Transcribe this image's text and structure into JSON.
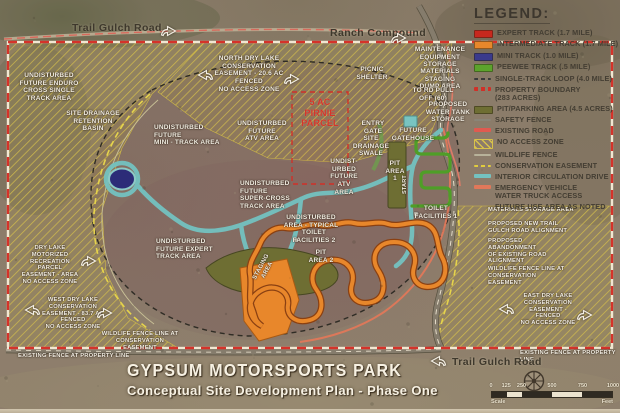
{
  "title": {
    "line1": "GYPSUM  MOTORSPORTS PARK",
    "line2": "Conceptual Site Development Plan - Phase One"
  },
  "legend": {
    "heading": "LEGEND:",
    "items": [
      {
        "label": "EXPERT TRACK (1.7 MILE)",
        "swatch": "solid",
        "color": "#c8281e"
      },
      {
        "label": "INTERMEDIATE TRACK (1.7 MILE)",
        "swatch": "solid",
        "color": "#e8872b"
      },
      {
        "label": "MINI TRACK (1.0 MILE)",
        "swatch": "solid",
        "color": "#3a3a8c"
      },
      {
        "label": "PEEWEE TRACK (.5 MILE)",
        "swatch": "solid",
        "color": "#5ca32c"
      },
      {
        "label": "SINGLE-TRACK LOOP (4.0 MILE)",
        "swatch": "dashed-thin",
        "color": "#3a3a3a"
      },
      {
        "label": "PROPERTY BOUNDARY\n(283 ACRES)",
        "swatch": "dashed",
        "color": "#d03028"
      },
      {
        "label": "PIT/PARKING AREA (4.5 ACRES)",
        "swatch": "solid",
        "color": "#6e6e33"
      },
      {
        "label": "SAFETY FENCE",
        "swatch": "line-thin",
        "color": "#8a8578"
      },
      {
        "label": "EXISTING ROAD",
        "swatch": "line",
        "color": "#e05a50"
      },
      {
        "label": "NO ACCESS ZONE",
        "swatch": "hatch",
        "color": "#d8c24a"
      },
      {
        "label": "WILDLIFE FENCE",
        "swatch": "line-thin",
        "color": "#b8b29a"
      },
      {
        "label": "CONSERVATION EASEMENT",
        "swatch": "dashed-thin",
        "color": "#e0cc3e"
      },
      {
        "label": "INTERIOR CIRCULATION DRIVE",
        "swatch": "line",
        "color": "#74c2c0"
      },
      {
        "label": "EMERGENCY VEHICLE\nWATER TRUCK ACCESS",
        "swatch": "line",
        "color": "#e0785a"
      },
      {
        "label": "FUTURE USE AREA AS NOTED",
        "swatch": "none",
        "color": ""
      }
    ]
  },
  "map": {
    "labels": [
      {
        "name": "trail-gulch-road-top-label",
        "text": "Trail Gulch Road",
        "x": 72,
        "y": 22,
        "cls": "dark"
      },
      {
        "name": "ranch-compound-label",
        "text": "Ranch Compound",
        "x": 330,
        "y": 27,
        "cls": "dark"
      },
      {
        "name": "enduro-area-label",
        "text": "UNDISTURBED\nFUTURE ENDURO\nCROSS SINGLE\nTRACK AREA",
        "x": 10,
        "y": 72,
        "w": 78
      },
      {
        "name": "retention-basin-label",
        "text": "SITE DRAINAGE\nRETENTION\nBASIN",
        "x": 62,
        "y": 110,
        "w": 62
      },
      {
        "name": "mini-track-area-label",
        "text": "UNDISTURBED\nFUTURE\nMINI - TRACK AREA",
        "x": 154,
        "y": 124,
        "w": 72,
        "align": "left"
      },
      {
        "name": "north-easement-label",
        "text": "NORTH DRY LAKE\nCONSERVATION\nEASEMENT - 20.6 AC\nFENCED\nNO ACCESS ZONE",
        "x": 214,
        "y": 55,
        "w": 70
      },
      {
        "name": "picnic-shelter-label",
        "text": "PICNIC\nSHELTER",
        "x": 352,
        "y": 66,
        "w": 40
      },
      {
        "name": "maintenance-storage-label",
        "text": "MAINTENANCE\nEQUIPMENT\nSTORAGE",
        "x": 414,
        "y": 46,
        "w": 52
      },
      {
        "name": "materials-dump-label",
        "text": "MATERIALS\nSTAGING\nDUMP AREA",
        "x": 414,
        "y": 68,
        "w": 52
      },
      {
        "name": "pulloff-label",
        "text": "TO RD PULL\nOFF (60)",
        "x": 410,
        "y": 87,
        "w": 46
      },
      {
        "name": "water-tank-label",
        "text": "PROPOSED\nWATER TANK\nSTORAGE",
        "x": 422,
        "y": 101,
        "w": 52
      },
      {
        "name": "pirnie-parcel-label",
        "text": "5 AC\nPIRNIE\nPARCEL",
        "x": 296,
        "y": 97,
        "w": 48,
        "cls": "red"
      },
      {
        "name": "atv-area-label",
        "text": "UNDISTURBED\nFUTURE\nATV AREA",
        "x": 236,
        "y": 120,
        "w": 52
      },
      {
        "name": "atv-area-label-2",
        "text": "UNDIST-\nURBED\nFUTURE\nATV AREA",
        "x": 327,
        "y": 158,
        "w": 34
      },
      {
        "name": "entry-gate-label",
        "text": "ENTRY\nGATE",
        "x": 358,
        "y": 120,
        "w": 30
      },
      {
        "name": "drainage-swale-label",
        "text": "SITE\nDRAINAGE\nSWALE",
        "x": 352,
        "y": 135,
        "w": 38
      },
      {
        "name": "future-gatehouse-label",
        "text": "FUTURE\nGATEHOUSE",
        "x": 390,
        "y": 127,
        "w": 46
      },
      {
        "name": "pit-area1-label",
        "text": "PIT\nAREA\n1",
        "x": 384,
        "y": 160,
        "w": 22
      },
      {
        "name": "start-label",
        "text": "START",
        "x": 402,
        "y": 194,
        "rot": -90,
        "size": 5.5
      },
      {
        "name": "toilet1-label",
        "text": "TOILET\nFACILITIES 1",
        "x": 412,
        "y": 205,
        "w": 48
      },
      {
        "name": "supercross-label",
        "text": "UNDISTURBED\nFUTURE\nSUPER-CROSS\nTRACK AREA",
        "x": 240,
        "y": 180,
        "w": 52,
        "align": "left"
      },
      {
        "name": "undisturbed-typical-label",
        "text": "UNDISTURBED\nAREA - TYPICAL",
        "x": 282,
        "y": 214,
        "w": 58
      },
      {
        "name": "toilet2-label",
        "text": "TOILET\nFACILITIES 2",
        "x": 290,
        "y": 229,
        "w": 48
      },
      {
        "name": "pit-area2-label",
        "text": "PIT\nAREA 2",
        "x": 306,
        "y": 249,
        "w": 30
      },
      {
        "name": "staging-area-label",
        "text": "STAGING\nAREA",
        "x": 252,
        "y": 278,
        "rot": -62,
        "size": 6
      },
      {
        "name": "expert-track-label",
        "text": "UNDISTURBED\nFUTURE EXPERT\nTRACK AREA",
        "x": 156,
        "y": 238,
        "w": 60,
        "align": "left"
      },
      {
        "name": "motorized-easement-label",
        "text": "DRY LAKE MOTORIZED\nRECREATION PARCEL\nEASEMENT - AREA\nNO ACCESS ZONE",
        "x": 18,
        "y": 245,
        "w": 64,
        "size": 5.8
      },
      {
        "name": "west-easement-label",
        "text": "WEST DRY LAKE\nCONSERVATION\nEASEMENT - 83.7 AC\nFENCED\nNO ACCESS ZONE",
        "x": 42,
        "y": 297,
        "w": 62,
        "size": 5.8
      },
      {
        "name": "wildlife-fence-sw-label",
        "text": "WILDLIFE FENCE LINE AT\nCONSERVATION EASEMENT",
        "x": 100,
        "y": 331,
        "w": 80,
        "size": 5.8
      },
      {
        "name": "existing-fence-sw-label",
        "text": "EXISTING FENCE AT PROPERTY LINE",
        "x": 18,
        "y": 353,
        "w": 112,
        "size": 5.8,
        "align": "left"
      },
      {
        "name": "materials-storage-label",
        "text": "MATERIALS STORAGE AREA",
        "x": 488,
        "y": 207,
        "w": 90,
        "align": "left",
        "size": 5.8
      },
      {
        "name": "new-alignment-label",
        "text": "PROPOSED NEW TRAIL\nGULCH ROAD ALIGNMENT",
        "x": 488,
        "y": 221,
        "w": 82,
        "align": "left",
        "size": 5.8
      },
      {
        "name": "abandonment-label",
        "text": "PROPOSED\nABANDONMENT\nOF EXISTING ROAD\nALIGNMENT",
        "x": 488,
        "y": 238,
        "w": 70,
        "align": "left",
        "size": 5.8
      },
      {
        "name": "wildlife-fence-e-label",
        "text": "WILDLIFE FENCE LINE AT\nCONSERVATION EASEMENT",
        "x": 488,
        "y": 266,
        "w": 82,
        "align": "left",
        "size": 5.8
      },
      {
        "name": "east-easement-label",
        "text": "EAST DRY LAKE\nCONSERVATION\nEASEMENT - FENCED\nNO ACCESS ZONE",
        "x": 516,
        "y": 293,
        "w": 64,
        "size": 5.8
      },
      {
        "name": "existing-fence-se-label",
        "text": "EXISTING FENCE AT PROPERTY LINE",
        "x": 520,
        "y": 350,
        "w": 100,
        "size": 5.8,
        "align": "left"
      },
      {
        "name": "trail-gulch-road-bottom-label",
        "text": "Trail Gulch Road",
        "x": 452,
        "y": 356,
        "cls": "dark"
      }
    ],
    "arrows": [
      {
        "name": "trail-gulch-top-arrow-icon",
        "x": 160,
        "y": 24,
        "dir": "right"
      },
      {
        "name": "ranch-compound-arrow-icon",
        "x": 390,
        "y": 31,
        "dir": "right"
      },
      {
        "name": "north-easement-left-arrow-icon",
        "x": 197,
        "y": 68,
        "dir": "left"
      },
      {
        "name": "north-easement-right-arrow-icon",
        "x": 283,
        "y": 72,
        "dir": "right"
      },
      {
        "name": "motorized-easement-arrow-icon",
        "x": 80,
        "y": 254,
        "dir": "right"
      },
      {
        "name": "west-easement-left-arrow-icon",
        "x": 24,
        "y": 303,
        "dir": "left"
      },
      {
        "name": "west-easement-right-arrow-icon",
        "x": 96,
        "y": 306,
        "dir": "right"
      },
      {
        "name": "east-easement-left-arrow-icon",
        "x": 498,
        "y": 302,
        "dir": "left"
      },
      {
        "name": "east-easement-right-arrow-icon",
        "x": 576,
        "y": 308,
        "dir": "right"
      },
      {
        "name": "trail-gulch-bottom-arrow-icon",
        "x": 430,
        "y": 354,
        "dir": "left"
      }
    ]
  },
  "scalebar": {
    "left_caption": "Scale",
    "right_caption": "Feet",
    "ticks": [
      {
        "label": "0",
        "pos": 0
      },
      {
        "label": "125",
        "pos": 12.5
      },
      {
        "label": "250",
        "pos": 25
      },
      {
        "label": "500",
        "pos": 50
      },
      {
        "label": "750",
        "pos": 75
      },
      {
        "label": "1000",
        "pos": 100
      }
    ],
    "segments": [
      {
        "w": 12.5,
        "c": "#2f2a22"
      },
      {
        "w": 12.5,
        "c": "#ece4d0"
      },
      {
        "w": 25,
        "c": "#2f2a22"
      },
      {
        "w": 25,
        "c": "#ece4d0"
      },
      {
        "w": 25,
        "c": "#2f2a22"
      }
    ]
  },
  "palette": {
    "property_boundary": "#d03028",
    "no_access_hatch": "#d8c24a",
    "interior_drive": "#74c2c0",
    "pit_area": "#6e6e33",
    "intermediate_track": "#e8872b",
    "peewee_track": "#5ca32c",
    "mini_track": "#3a3a8c",
    "expert_track": "#c8281e",
    "emergency_access": "#e0785a"
  }
}
